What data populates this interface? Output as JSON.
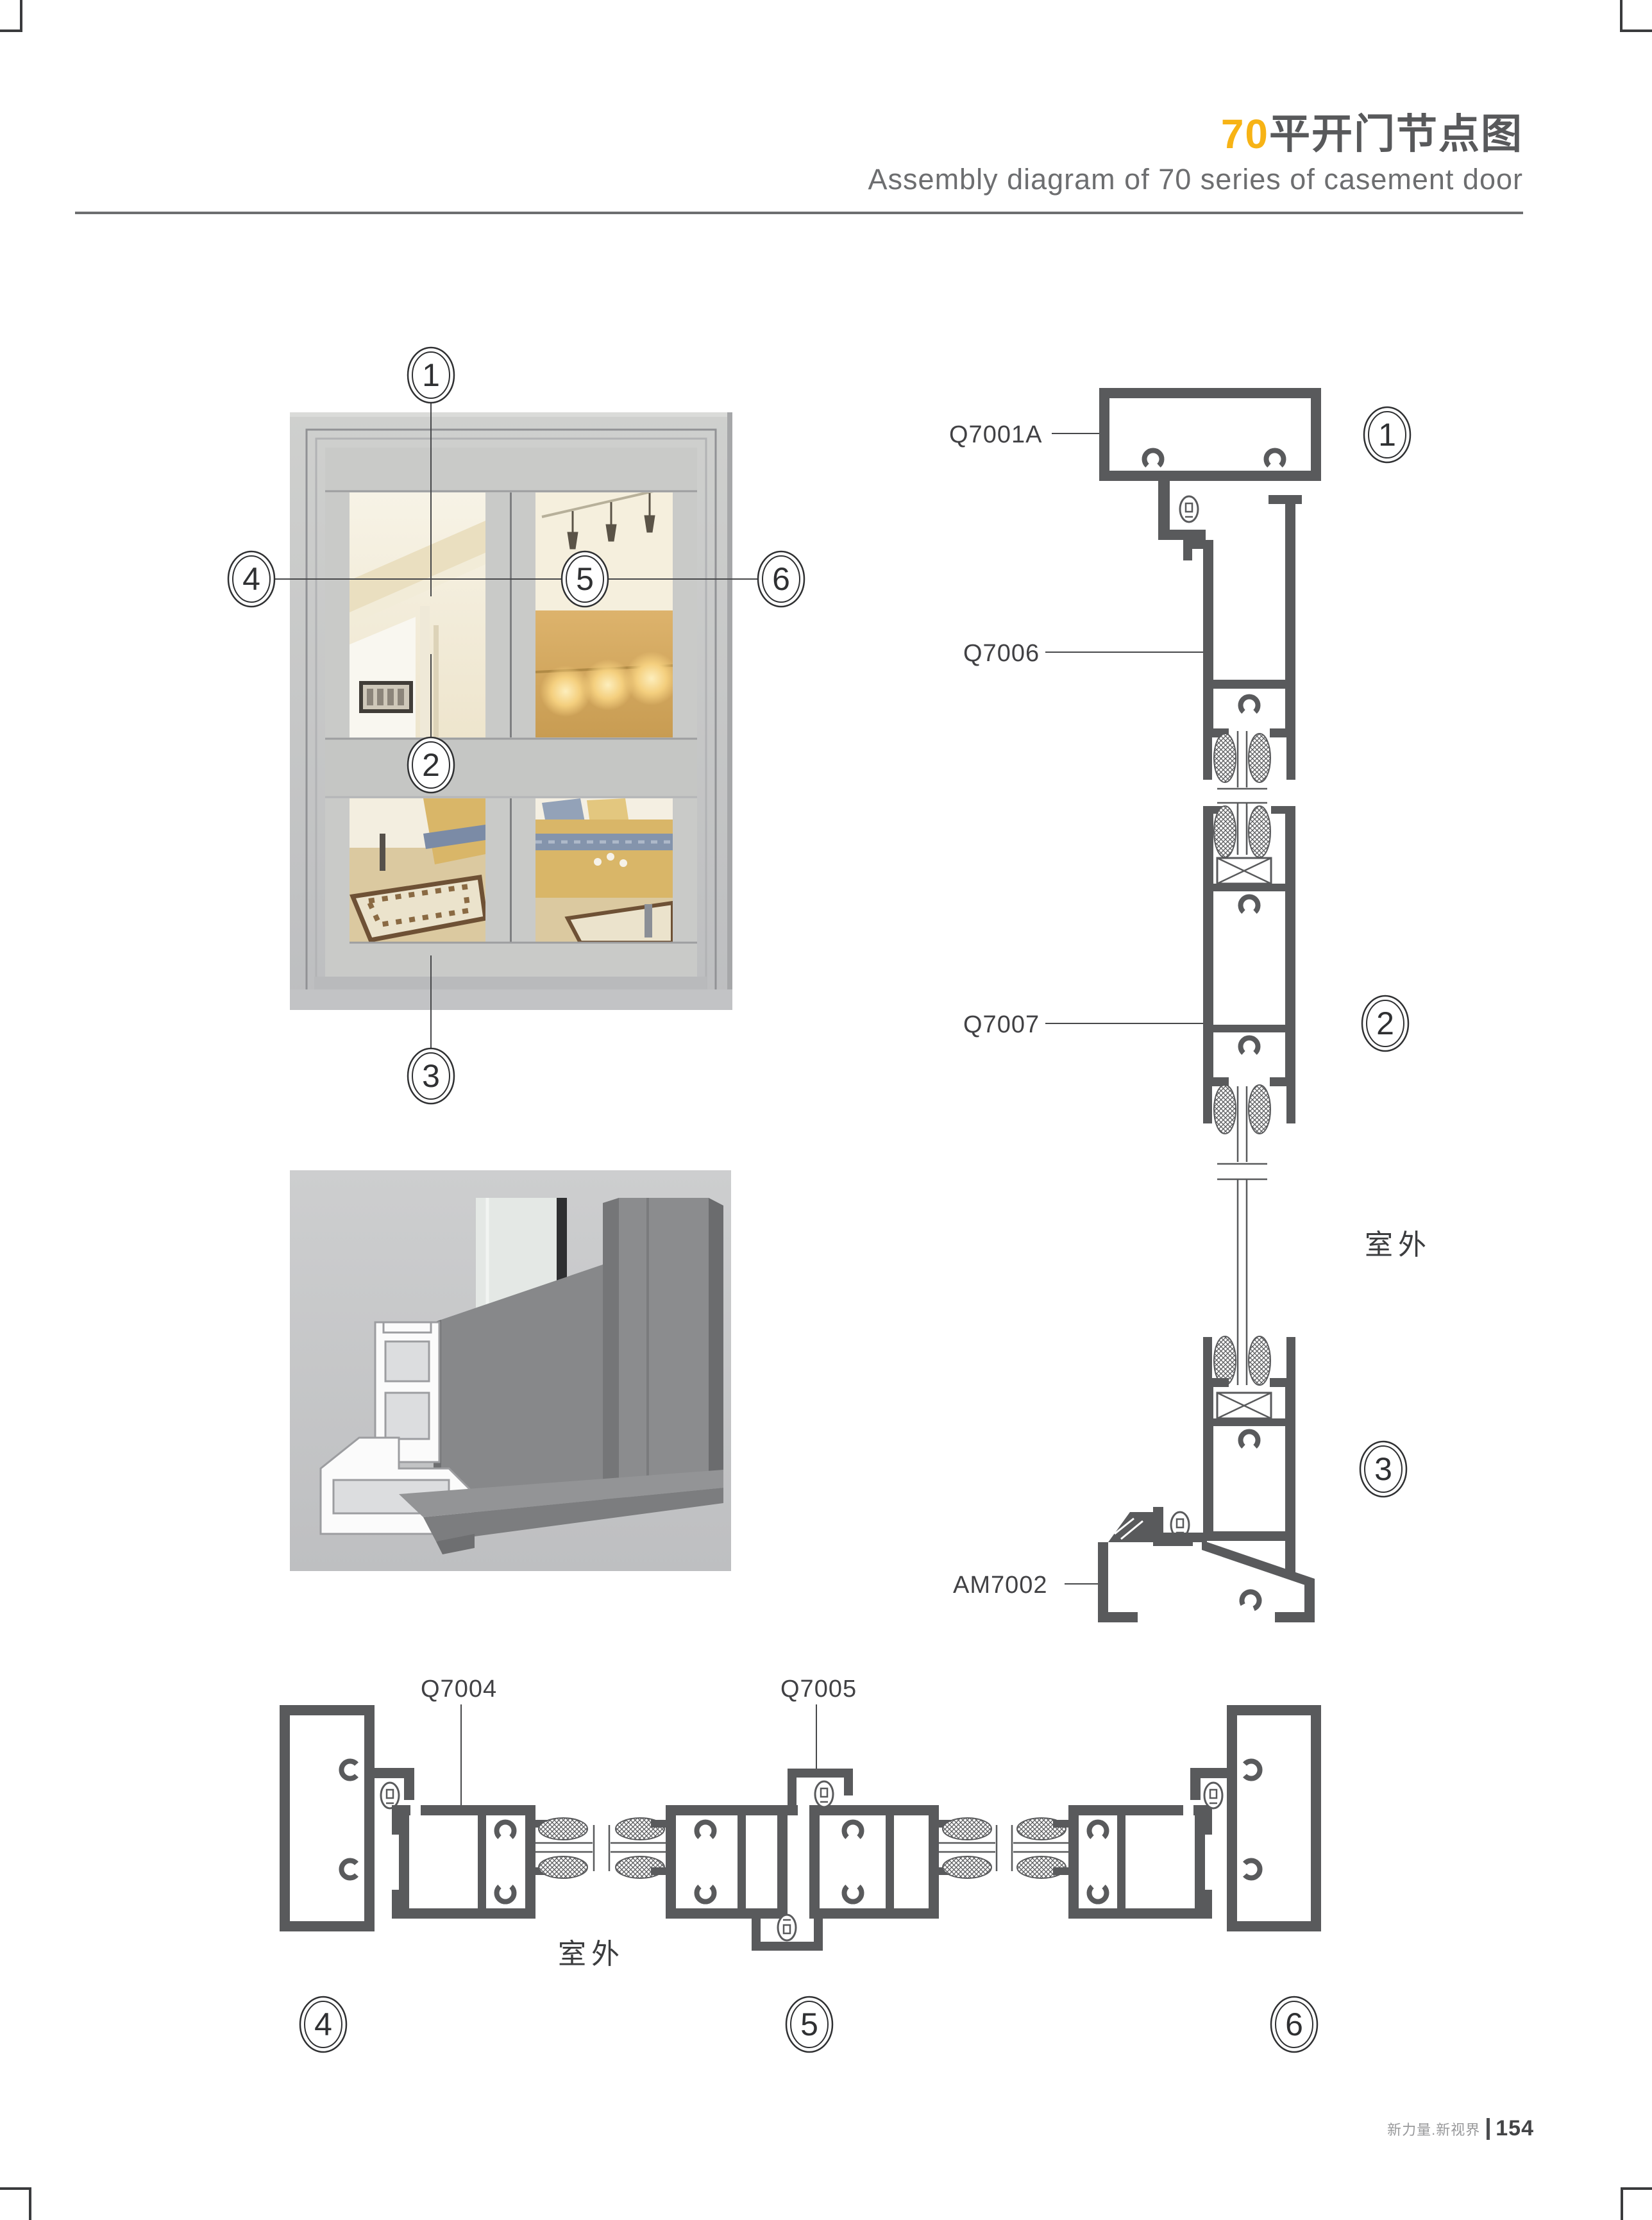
{
  "page": {
    "title_accent": "70",
    "title_main": "平开门节点图",
    "subtitle": "Assembly diagram of 70 series of casement door",
    "footer_brand": "新力量.新视界",
    "footer_page": "154"
  },
  "colors": {
    "accent_orange": "#f7b315",
    "heading_gray": "#58595b",
    "drawing_gray": "#595a5c",
    "rule_gray": "#6d6e70"
  },
  "photo_callouts": {
    "c1": "1",
    "c2": "2",
    "c3": "3",
    "c4": "4",
    "c5": "5",
    "c6": "6"
  },
  "vertical_section": {
    "label_head_frame": "Q7001A",
    "label_top_rail": "Q7006",
    "label_mid_rail": "Q7007",
    "label_sill": "AM7002",
    "outdoor": "室外",
    "callout_1": "1",
    "callout_2": "2",
    "callout_3": "3"
  },
  "horizontal_section": {
    "label_stile": "Q7004",
    "label_astragal": "Q7005",
    "outdoor": "室外",
    "callout_4": "4",
    "callout_5": "5",
    "callout_6": "6"
  }
}
